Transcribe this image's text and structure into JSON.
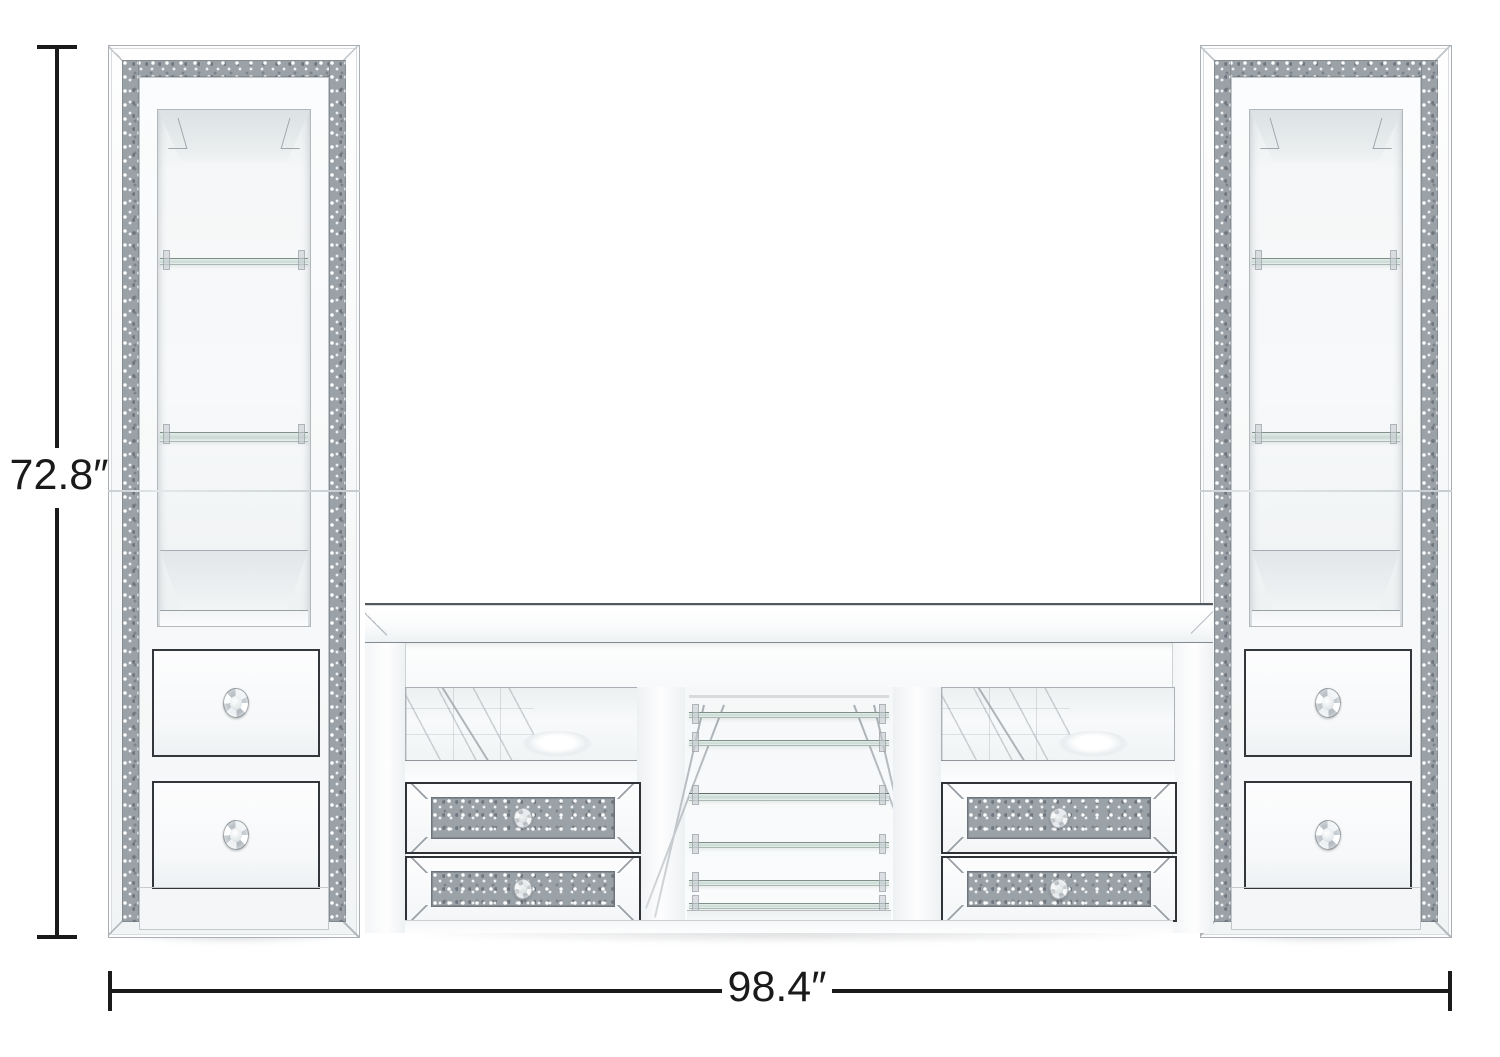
{
  "diagram": {
    "height": {
      "label": "72.8″",
      "inches": 72.8
    },
    "width": {
      "label": "98.4″",
      "inches": 98.4
    }
  },
  "colors": {
    "background": "#ffffff",
    "dimension_line": "#1b1b1b",
    "mirror_light": "#f4f6f7",
    "sparkle_crystal": "#9aa1a7",
    "glass_shelf": "#c8d8d2",
    "drawer_outline": "#2f3338"
  }
}
